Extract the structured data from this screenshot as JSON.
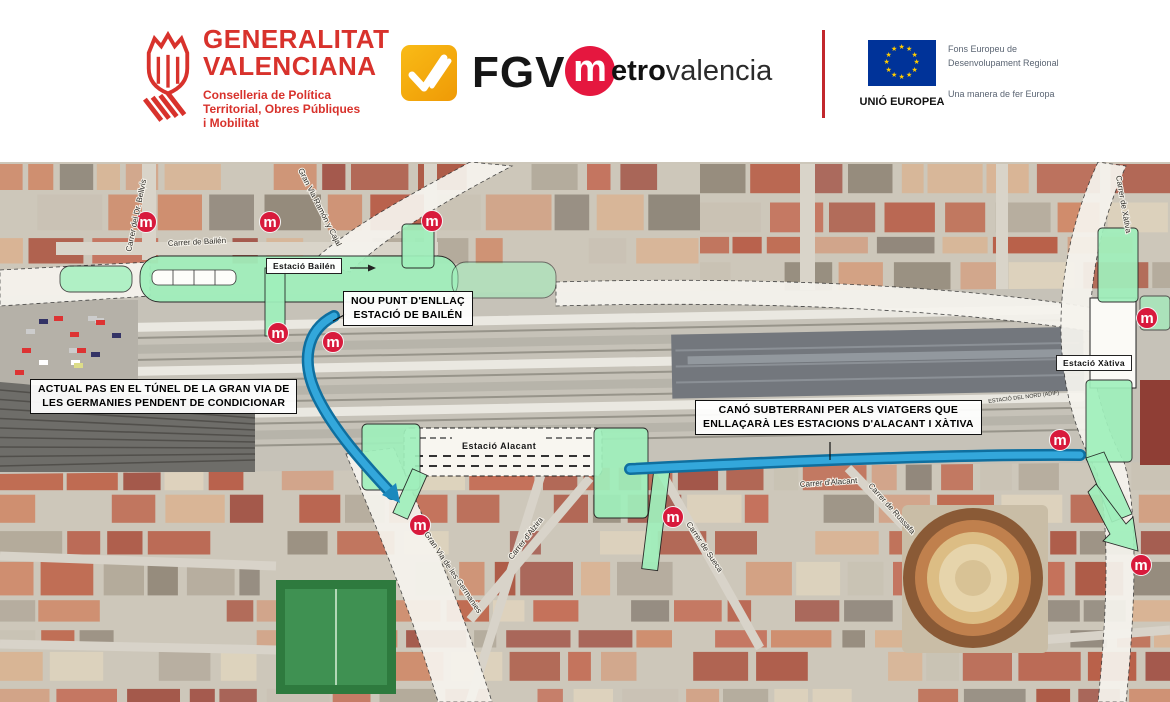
{
  "header": {
    "gva": {
      "name_line1": "GENERALITAT",
      "name_line2": "VALENCIANA",
      "dept_lines": [
        "Conselleria de Política",
        "Territorial, Obres Públiques",
        "i Mobilitat"
      ],
      "brand_color": "#d8322c"
    },
    "fgv": {
      "label": "FGV",
      "tile_color": "#f5a90e"
    },
    "metrovalencia": {
      "circle_letter": "m",
      "text_bold": "etro",
      "text_light": "valencia",
      "circle_color": "#e5173f"
    },
    "eu": {
      "flag_caption": "UNIÓ EUROPEA",
      "fund_line1": "Fons Europeu de",
      "fund_line2": "Desenvolupament Regional",
      "motto": "Una manera de fer Europa",
      "flag_blue": "#003399",
      "star_yellow": "#ffcc00"
    }
  },
  "map": {
    "palette": {
      "station_area_green": "#a0f0bc",
      "tunnel_blue": "#2aa4da",
      "metro_red": "#d81a3c"
    },
    "callouts": [
      {
        "id": "nou-punt-enllac",
        "lines": [
          "NOU PUNT D'ENLLAÇ",
          "ESTACIÓ DE BAILÉN"
        ],
        "x": 343,
        "y": 291
      },
      {
        "id": "actual-pas",
        "lines": [
          "ACTUAL PAS EN EL TÚNEL DE LA GRAN VIA DE",
          "LES GERMANIES PENDENT DE CONDICIONAR"
        ],
        "x": 30,
        "y": 379
      },
      {
        "id": "cano-subterrani",
        "lines": [
          "CANÓ SUBTERRANI PER ALS VIATGERS QUE",
          "ENLLAÇARÀ LES ESTACIONS D'ALACANT I XÀTIVA"
        ],
        "x": 695,
        "y": 400
      }
    ],
    "station_tags": [
      {
        "id": "estacio-bailen",
        "label": "Estació Bailén",
        "x": 266,
        "y": 258,
        "boxed": true
      },
      {
        "id": "estacio-xativa",
        "label": "Estació Xàtiva",
        "x": 1056,
        "y": 355,
        "boxed": true
      },
      {
        "id": "estacio-alacant",
        "label": "Estació Alacant",
        "x": 462,
        "y": 441,
        "boxed": false
      }
    ],
    "tiny_labels": [
      {
        "text": "ESTACIÓ DEL NORD (ADIF)",
        "x": 988,
        "y": 399,
        "rot": -7
      }
    ],
    "street_labels": [
      {
        "text": "Carrer de Bailén",
        "x": 168,
        "y": 246,
        "rot": -3
      },
      {
        "text": "Carrer del Dr. Bellvís",
        "x": 131,
        "y": 252,
        "rot": -78
      },
      {
        "text": "Gran Via Ramón y Cajal",
        "x": 298,
        "y": 170,
        "rot": 63
      },
      {
        "text": "Carrer de Xàtiva",
        "x": 1116,
        "y": 176,
        "rot": 80
      },
      {
        "text": "Gran Via de les Germanies",
        "x": 424,
        "y": 534,
        "rot": 56
      },
      {
        "text": "Carrer d'Alzira",
        "x": 512,
        "y": 560,
        "rot": -52
      },
      {
        "text": "Carrer de Sueca",
        "x": 686,
        "y": 524,
        "rot": 56
      },
      {
        "text": "Carrer d'Alacant",
        "x": 800,
        "y": 487,
        "rot": -4
      },
      {
        "text": "Carrer de Russafa",
        "x": 868,
        "y": 486,
        "rot": 48
      }
    ],
    "metro_markers": [
      {
        "x": 146,
        "y": 222
      },
      {
        "x": 270,
        "y": 222
      },
      {
        "x": 432,
        "y": 221
      },
      {
        "x": 278,
        "y": 333
      },
      {
        "x": 333,
        "y": 342
      },
      {
        "x": 420,
        "y": 525
      },
      {
        "x": 673,
        "y": 517
      },
      {
        "x": 1147,
        "y": 318
      },
      {
        "x": 1060,
        "y": 440
      },
      {
        "x": 1141,
        "y": 565
      }
    ],
    "marker_letter": "m"
  }
}
